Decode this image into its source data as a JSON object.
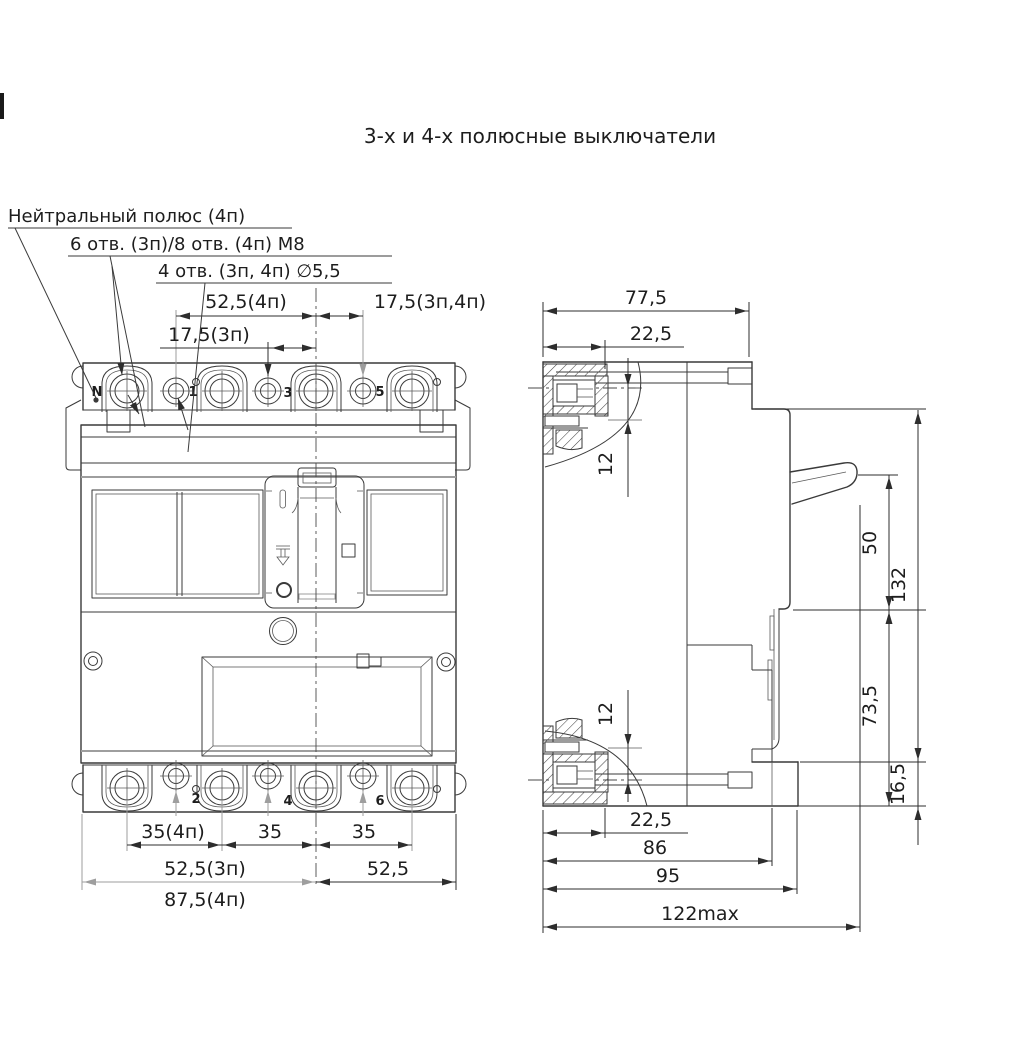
{
  "title": "3-х и 4-х полюсные выключатели",
  "colors": {
    "line": "#3a3a3a",
    "light_line": "#9e9e9e",
    "text": "#1d1d1d",
    "background": "#ffffff"
  },
  "callouts": {
    "neutral_pole": "Нейтральный полюс (4п)",
    "holes_m8": "6 отв. (3п)/8 отв. (4п) М8",
    "holes_d55": "4 отв. (3п, 4п) ∅5,5"
  },
  "front_view": {
    "pole_labels_top": [
      "N",
      "1",
      "3",
      "5"
    ],
    "pole_labels_bottom": [
      "2",
      "4",
      "6"
    ],
    "dims": {
      "top_center_4p": "52,5(4п)",
      "top_right": "17,5(3п,4п)",
      "top_center_3p": "17,5(3п)",
      "pitch_4p": "35(4п)",
      "pitch_mid": "35",
      "pitch_right": "35",
      "half_width_3p": "52,5(3п)",
      "half_width_4p": "87,5(4п)",
      "half_width_right": "52,5"
    }
  },
  "side_view": {
    "dims": {
      "depth_77": "77,5",
      "terminal_depth_top": "22,5",
      "offset_top": "12",
      "handle_50": "50",
      "height_132": "132",
      "lower_73": "73,5",
      "foot_16": "16,5",
      "offset_bottom": "12",
      "terminal_depth_bottom": "22,5",
      "depth_86": "86",
      "depth_95": "95",
      "depth_max": "122max"
    }
  }
}
